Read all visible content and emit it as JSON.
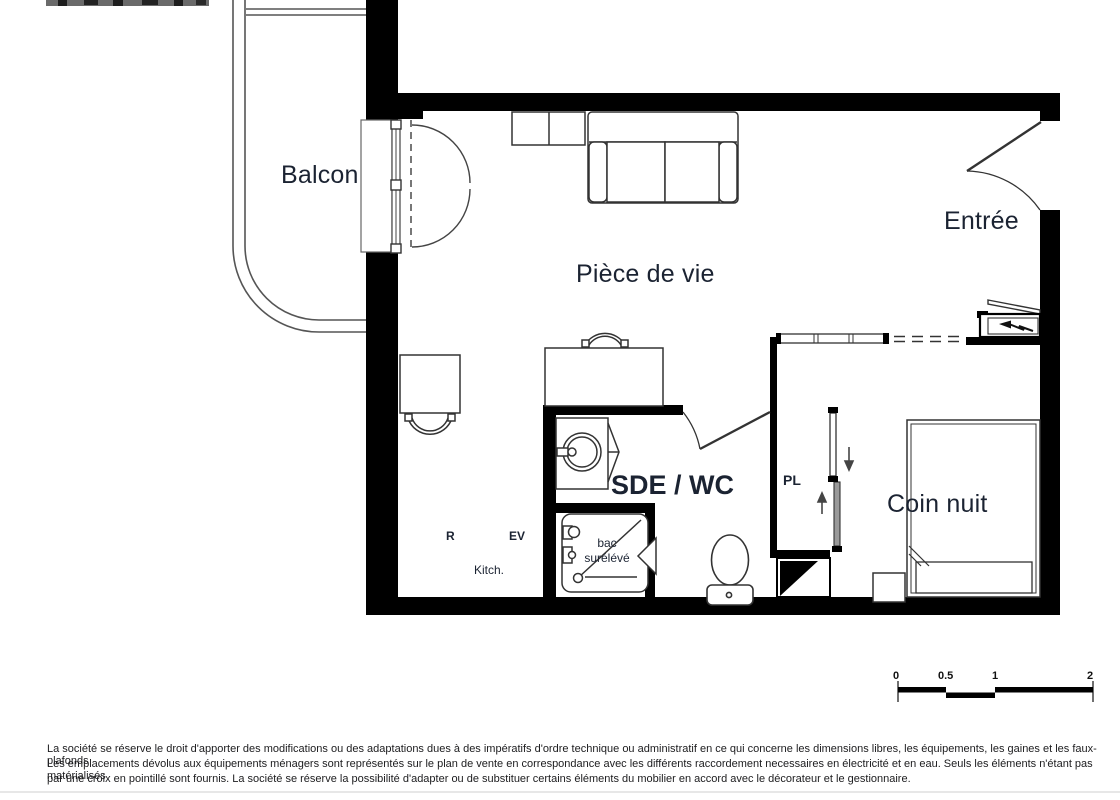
{
  "rooms": {
    "balcony": "Balcon",
    "living_room": "Pièce de vie",
    "entrance": "Entrée",
    "bathroom": "SDE / WC",
    "sleeping_area": "Coin nuit",
    "closet": "PL"
  },
  "fixtures": {
    "kitchen_label": "Kitch.",
    "fridge_label": "R",
    "sink_label": "EV",
    "shower_label_line1": "bac",
    "shower_label_line2": "surélévé"
  },
  "scale_bar": {
    "tick_0": "0",
    "tick_05": "0.5",
    "tick_1": "1",
    "tick_2": "2"
  },
  "disclaimer": {
    "line1": "La société se réserve le droit d'apporter des modifications ou des adaptations dues à des impératifs d'ordre technique ou administratif en ce qui concerne les dimensions libres, les équipements, les gaines et les faux-plafonds",
    "line2": "Les emplacements dévolus aux équipements ménagers sont représentés sur le plan de vente en correspondance avec les différents raccordement necessaires en électricité et en eau. Seuls les éléments n'étant pas matérialisés",
    "line3": "par une croix en pointillé sont fournis. La société se réserve la possibilité d'adapter ou de substituer certains éléments du mobilier en accord avec le décorateur et le gestionnaire."
  }
}
